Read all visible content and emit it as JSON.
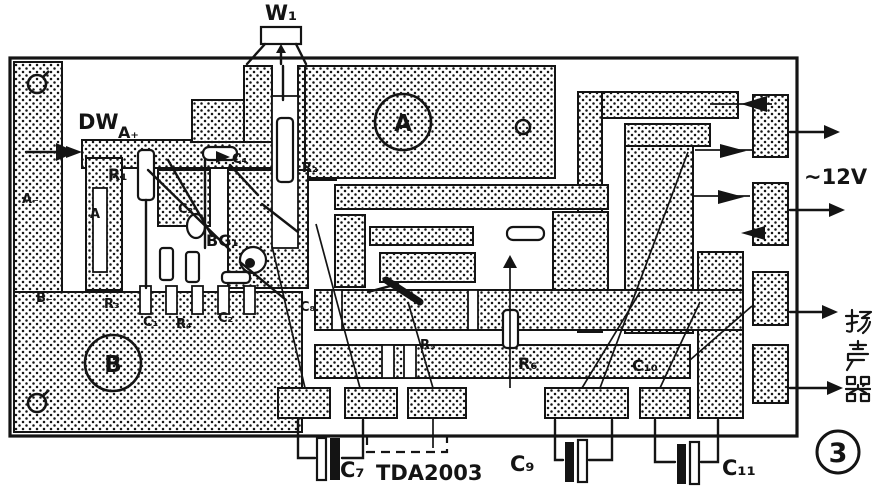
{
  "figure": {
    "kind": "printed-circuit-board layout diagram",
    "ic": "TDA2003",
    "number": "3"
  },
  "colors": {
    "ink": "#141414",
    "paper": "#ffffff"
  },
  "labels": {
    "w1": "W₁",
    "dw": "DW",
    "a_plus": "A₊",
    "r1": "R₁",
    "c4": "C₄",
    "c3": "C₃",
    "bg1": "BG₁",
    "r2": "R₂",
    "cluster_a": "A",
    "hole_a": "A",
    "hole_b": "B",
    "a_minus": "A₋",
    "b_minus": "B₋",
    "r3": "R₃",
    "c1": "C₁",
    "r4": "R₄",
    "c2": "C₂",
    "c8": "C₈",
    "r5": "R₅",
    "r6": "R₆",
    "c10": "C₁₀",
    "c7": "C₇",
    "tda": "TDA2003",
    "c9": "C₉",
    "c11": "C₁₁",
    "supply": "~12V",
    "speaker": "扬声器",
    "fig": "3"
  }
}
